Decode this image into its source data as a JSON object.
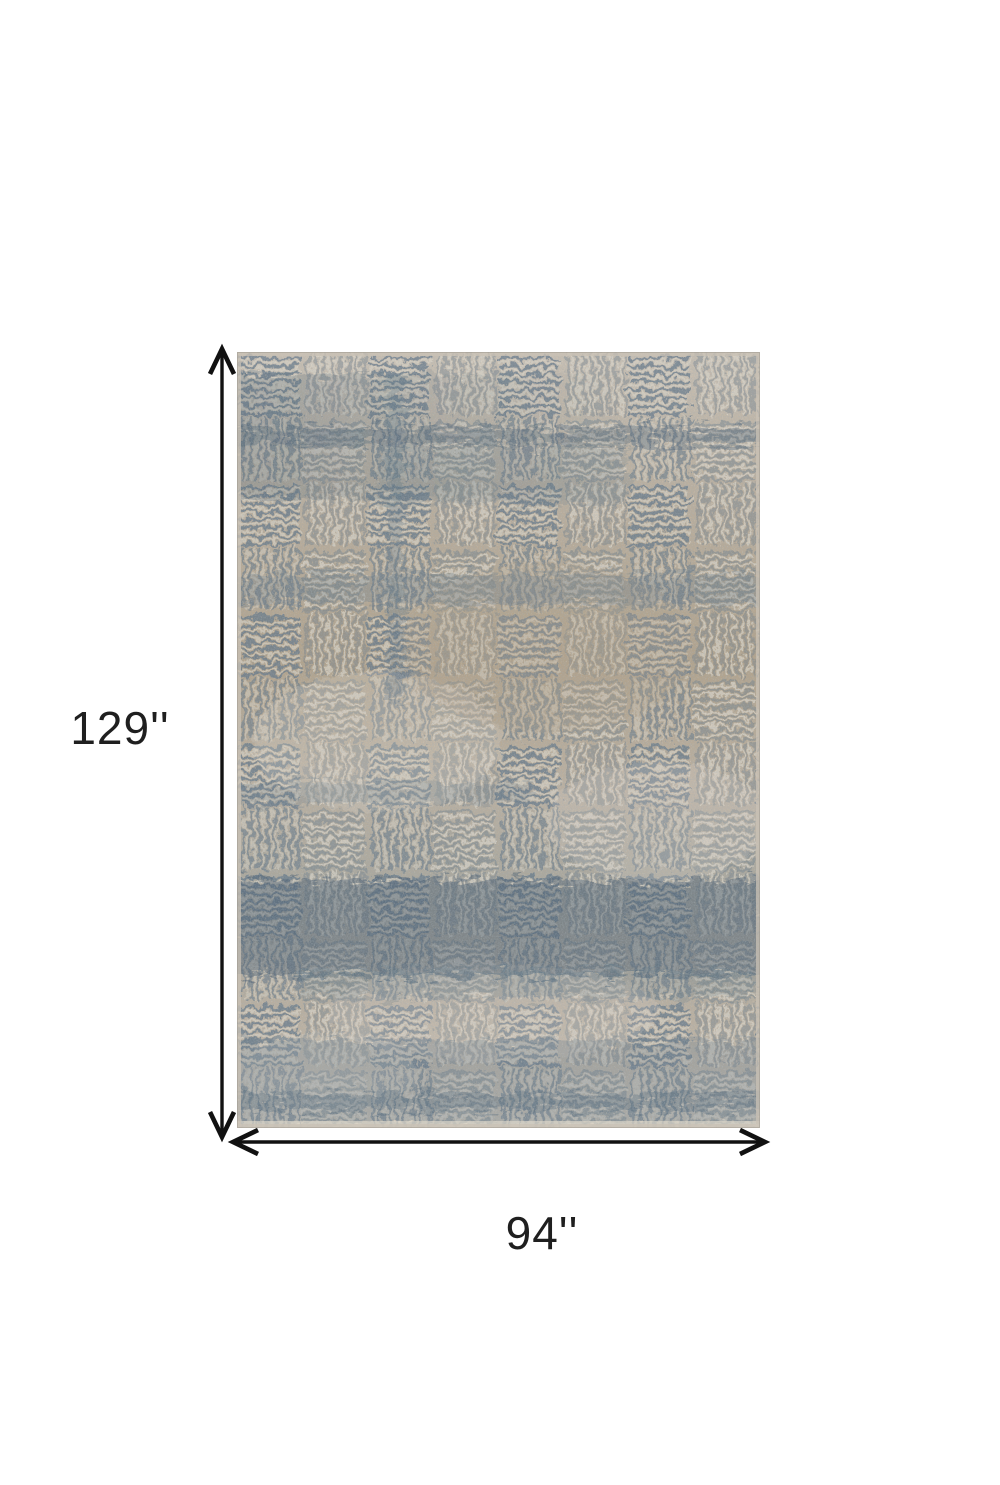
{
  "image": {
    "alt": "Distressed abstract basketweave area rug in beige, tan and blue-gray shown with dimension arrows"
  },
  "dimensions": {
    "height_label": "129''",
    "width_label": "94''"
  },
  "colors": {
    "page-bg": "#ffffff",
    "arrow": "#111111",
    "label": "#1f1f1f",
    "rug-beige-light": "#cac0b2",
    "rug-beige": "#bcb09f",
    "rug-tan": "#b2a28a",
    "rug-gray": "#a9a69b",
    "rug-cream": "#ded8cb",
    "rug-blue": "#5e7386",
    "rug-blue-dark": "#435a6c",
    "rug-edge": "#c9c2b6"
  }
}
